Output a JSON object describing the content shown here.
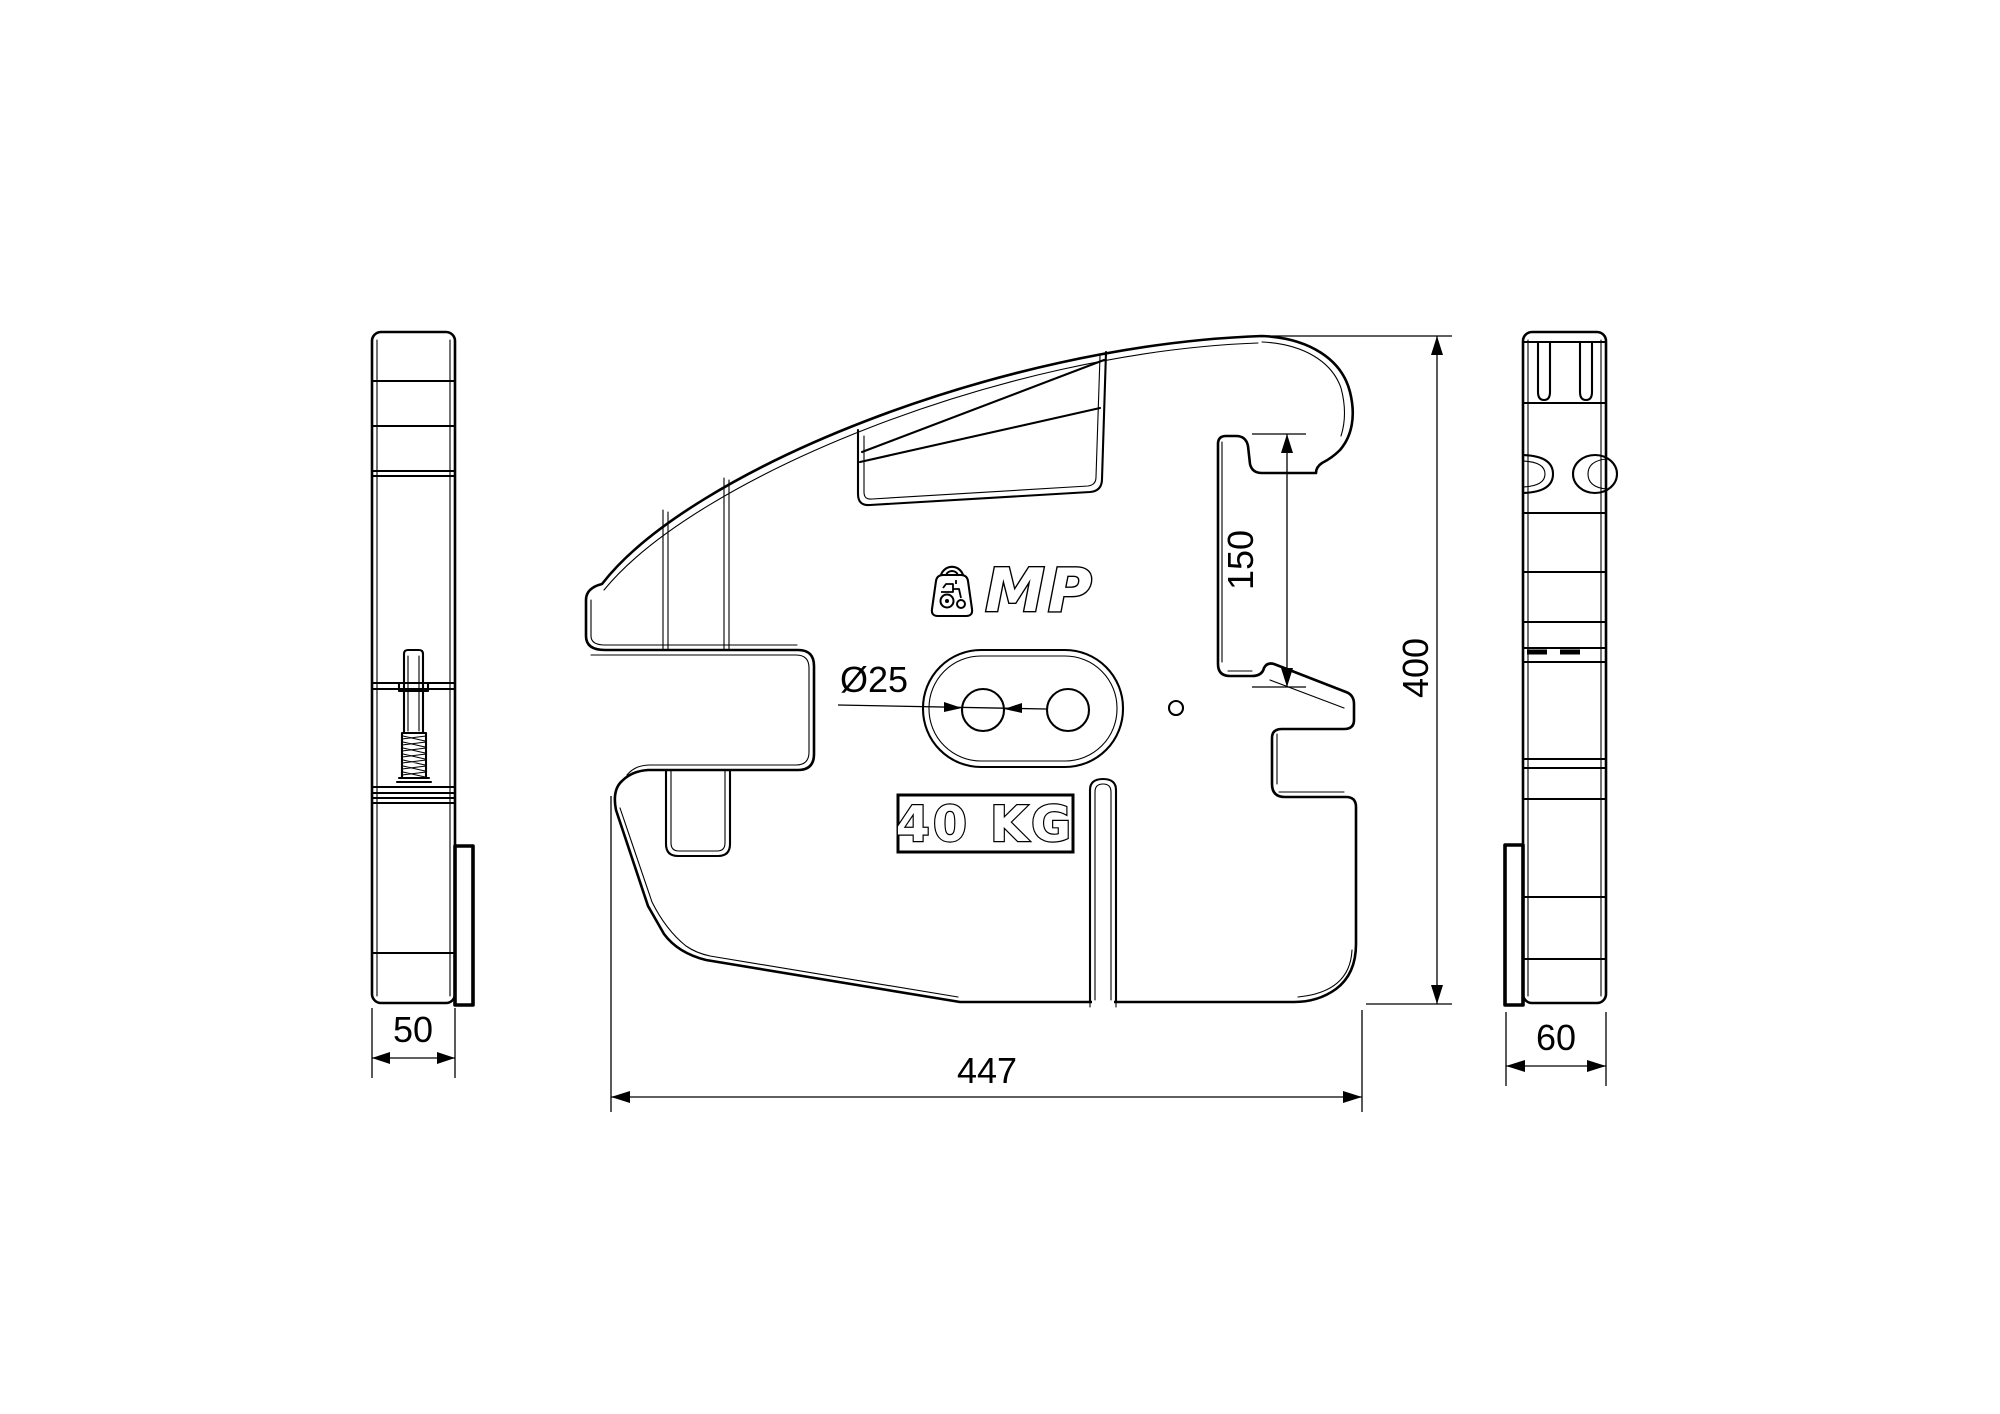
{
  "drawing": {
    "background": "#ffffff",
    "ink_color": "#000000",
    "type": "technical-drawing",
    "subject": "front tractor suitcase weight, three orthographic views"
  },
  "logo": {
    "brand": "MP",
    "icon": "weight-tractor-icon"
  },
  "plate": {
    "weight_label": "40 KG"
  },
  "dimensions": {
    "front_width": "447",
    "front_height": "400",
    "notch_height": "150",
    "left_view_thickness": "50",
    "right_view_thickness": "60",
    "hole_diameter": "Ø25"
  }
}
